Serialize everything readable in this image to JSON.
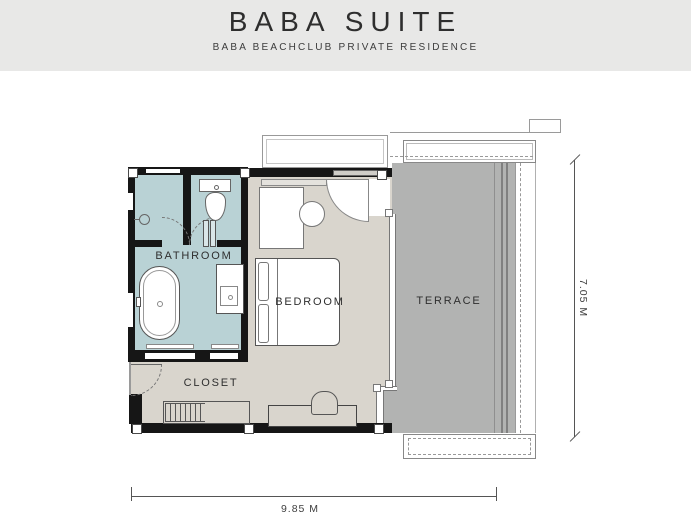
{
  "header": {
    "title": "BABA SUITE",
    "subtitle": "BABA BEACHCLUB PRIVATE RESIDENCE"
  },
  "plan": {
    "rooms": [
      {
        "id": "bathroom",
        "label": "BATHROOM"
      },
      {
        "id": "bedroom",
        "label": "BEDROOM"
      },
      {
        "id": "terrace",
        "label": "TERRACE"
      },
      {
        "id": "closet",
        "label": "CLOSET"
      }
    ],
    "dimensions": {
      "width_label": "9.85 M",
      "height_label": "7.05 M"
    }
  },
  "colors": {
    "header_bg": "#e8e8e7",
    "bathroom_fill": "#b9d2d5",
    "bedroom_fill": "#d9d5cd",
    "terrace_fill": "#b2b3b2",
    "wall": "#161616",
    "text": "#2e2e2e"
  }
}
